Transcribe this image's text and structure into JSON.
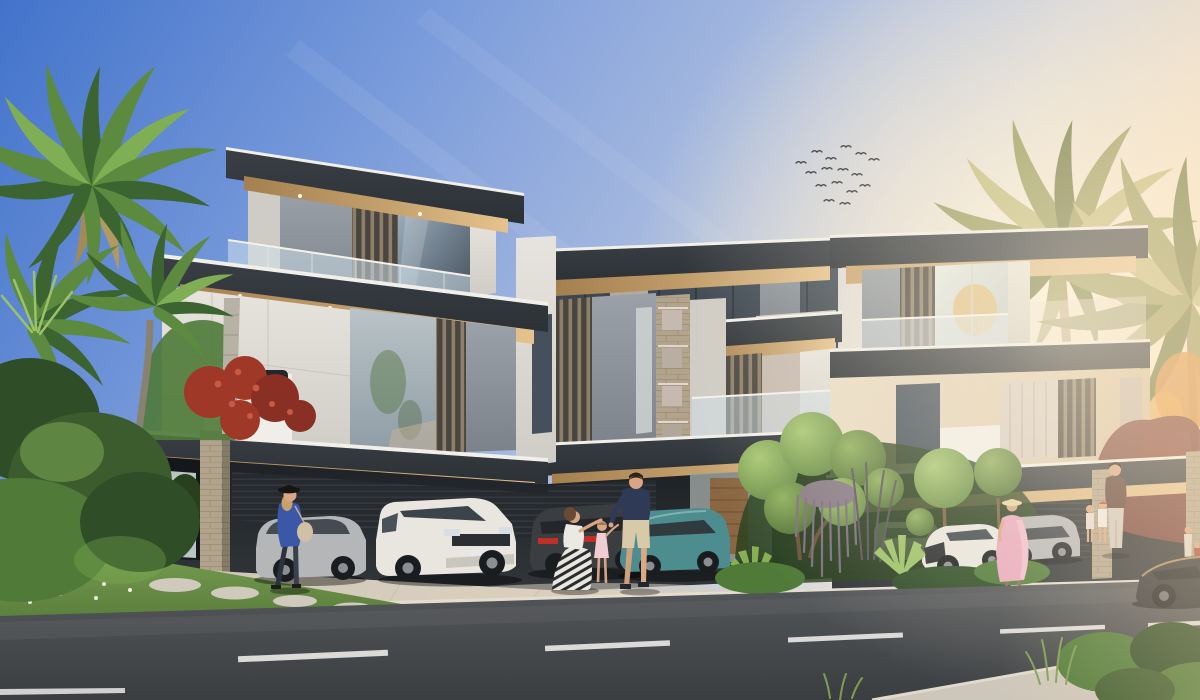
{
  "meta": {
    "description": "Photorealistic architectural rendering of a row of modern three-storey luxury villas at sunset, with palm trees, landscaped topiary garden, parked cars under carports, pedestrians on the driveway, and an asphalt road with dashed lane markings in the foreground. A flock of birds flies in the upper right sky. Warm sun glow enters from the right; no text, UI elements or watermarks are visible.",
    "canvas": {
      "width": 1200,
      "height": 700
    }
  },
  "palette": {
    "sky_top": "#4273cb",
    "sky_mid": "#7b9cdb",
    "sky_mid2": "#a9bbdf",
    "sky_low": "#ccd2e2",
    "sky_warm": "#f4e7d3",
    "sun_glow": "#fff3dc",
    "roof_dark": "#3a3f45",
    "roof_darker": "#2c3136",
    "roof_edge": "#f1efe9",
    "soffit_warm": "#c8a471",
    "soffit_deep": "#a5804f",
    "soffit_bright": "#e5c28e",
    "wall_white": "#e7e4de",
    "wall_white_shade": "#cfccc5",
    "wall_bright": "#f0eee8",
    "wall_gray": "#9aa1a8",
    "wall_gray_dark": "#7b828a",
    "wall_cream": "#e9dcc6",
    "wall_cream_deep": "#d8c3a4",
    "glass_cool": "#8ea3b6",
    "glass_dark": "#45505c",
    "glass_deep": "#2e353d",
    "glass_warm": "#c6bab0",
    "curtain": "#d8cec4",
    "louver_bg": "#4a463f",
    "louver_slat": "#8d7f6a",
    "stone": "#b2a48c",
    "stone_dark": "#8f8268",
    "cavity": "#1d2125",
    "cavity_lit": "#31363b",
    "slat_line": "#343a40",
    "wood": "#8a6642",
    "drive": "#c9c2b3",
    "drive_warm": "#dcd2c0",
    "curb": "#e3ddd0",
    "road_top": "#55585b",
    "road_bot": "#3b3e41",
    "marking": "#eceae6",
    "grass": "#74994e",
    "grass_dark": "#4e7234",
    "bush_dark": "#2f4d27",
    "bush_mid": "#4f7a38",
    "bush_light": "#7fae54",
    "palm_dark": "#3c6430",
    "palm_mid": "#5c8a3e",
    "palm_light": "#7fae54",
    "palm_warm_dark": "#6f7a44",
    "palm_warm": "#999c60",
    "palm_warm_light": "#c2bd80",
    "dry_frond": "#b09a62",
    "trunk": "#b6b2a6",
    "trunk_warm": "#a88f68",
    "red_flower": "#a03828",
    "red_flower_light": "#c65a42",
    "red_tree": "#7c4038",
    "orange_tree": "#d98f42",
    "wisteria": "#877a85",
    "agave": "#9cc268",
    "car_white": "#e9e6df",
    "car_silver": "#b4b6b7",
    "car_dark": "#3a3e41",
    "car_teal": "#4e8d8f",
    "car_black": "#2c3034",
    "tire": "#1a1d20",
    "hub": "#8b8f93",
    "taillight": "#c03028",
    "glass_car": "#3c444b",
    "skin": "#d9a582",
    "navy": "#2e3a56",
    "blue_top": "#3a57a8",
    "pink_dress": "#e8a9bd",
    "pink_light": "#f2c3d2",
    "beige_shorts": "#d8c9a8",
    "straw_hat": "#e6d3a3",
    "white_cloth": "#ece8e2",
    "dark_red_top": "#5a3a34",
    "pants_light": "#cfc8bd",
    "hair_dark": "#2a2018",
    "hair_brown": "#6b4a33",
    "hair_blonde": "#c9a06a",
    "bag": "#cfc0a6",
    "bird": "#2b2d2e"
  },
  "scene": {
    "sky": {
      "time_of_day": "sunset",
      "glow_side": "right",
      "birds_count": 16
    },
    "buildings": {
      "style": "modern flat-roof villas, 3 storeys, glass balustrades, vertical louvers, stone-clad pillars, cantilevered carport canopies",
      "left_villa": {
        "features": [
          "rooftop terrace tower",
          "glass balcony",
          "large picture window",
          "double carport with two cars",
          "travertine pillar"
        ]
      },
      "center_villas": {
        "features": [
          "glass clerestory band",
          "stacked stone window column",
          "wood entry door",
          "carport with two cars"
        ]
      },
      "right_villa": {
        "features": [
          "sunlit glass corner",
          "cream walls",
          "curtained windows",
          "carport",
          "stone pillar"
        ]
      }
    },
    "vegetation": {
      "left": [
        "palm cluster",
        "dense shrubs",
        "red bougainvillea",
        "lawn with stepping stones",
        "white ground flowers"
      ],
      "center": [
        "cloud-pruned topiary tree",
        "hanging purple wisteria",
        "ball topiary standards",
        "agave plants",
        "dark ornamental grasses"
      ],
      "right": [
        "two backlit palms",
        "orange tree",
        "dark-red tree",
        "roadside bushes and grasses"
      ]
    },
    "vehicles": [
      {
        "name": "silver-sedan",
        "location": "left carport",
        "color": "silver"
      },
      {
        "name": "white-suv-landrover",
        "location": "left carport",
        "color": "white"
      },
      {
        "name": "dark-suv",
        "location": "center carport",
        "color": "dark gray",
        "detail": "red taillights"
      },
      {
        "name": "teal-suv",
        "location": "center carport",
        "color": "teal"
      },
      {
        "name": "white-car-partial",
        "location": "behind garden",
        "color": "white"
      },
      {
        "name": "white-mazda-crossover",
        "location": "right driveway",
        "color": "white"
      },
      {
        "name": "silver-suv",
        "location": "right driveway",
        "color": "silver"
      },
      {
        "name": "black-sedan",
        "location": "road far right",
        "color": "black"
      }
    ],
    "people": [
      {
        "name": "woman-blue-top",
        "detail": "black hat, beige handbag, walking left"
      },
      {
        "name": "kneeling-mother",
        "detail": "white top, black-and-white patterned skirt"
      },
      {
        "name": "child-pink-dress",
        "detail": "standing between parents"
      },
      {
        "name": "father-navy-tshirt",
        "detail": "beige shorts, standing"
      },
      {
        "name": "woman-pink-dress",
        "detail": "straw hat, walking right"
      },
      {
        "name": "man-dark-top-right",
        "detail": "light trousers, with two children"
      },
      {
        "name": "child-right-a",
        "detail": "pale pink outfit"
      },
      {
        "name": "child-right-b",
        "detail": "white top, red hair"
      },
      {
        "name": "pair-far-right",
        "detail": "small figures at image edge"
      }
    ],
    "road": {
      "surface": "asphalt",
      "lane_dashes": 5,
      "solid_line_bottom_left": true,
      "direction": "diagonal, lower-left to mid-right"
    }
  }
}
